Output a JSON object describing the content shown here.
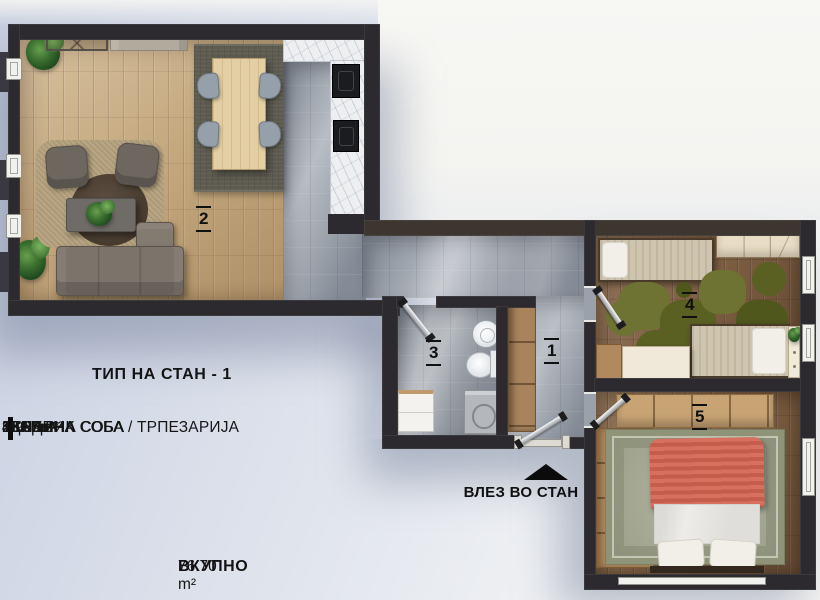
{
  "legend": {
    "title": "ТИП НА СТАН - 1",
    "rows": [
      {
        "num": "1",
        "label": "ХОДНИК",
        "area": "10.05 m²"
      },
      {
        "num": "2",
        "label": "ДНЕВНА СОБА / ТРПЕЗАРИЈА",
        "area": "35.85 m²"
      },
      {
        "num": "3",
        "label": "БАЊА",
        "area": "4.90 m²"
      },
      {
        "num": "4",
        "label": "СПАЛНА СОБА",
        "area": "11.95m²"
      },
      {
        "num": "5",
        "label": "СПАЛНА СОБА",
        "area": "13.95m²"
      }
    ],
    "total_label": "ВКУПНО",
    "total_sep": "-",
    "total_area": "76.70 m²"
  },
  "entrance": {
    "label": "ВЛЕЗ ВО СТАН"
  },
  "rooms": {
    "hallway": {
      "number": "1"
    },
    "living": {
      "number": "2"
    },
    "bathroom": {
      "number": "3"
    },
    "bedroom4": {
      "number": "4"
    },
    "bedroom5": {
      "number": "5"
    }
  },
  "colors": {
    "wall": "#2c2a2e",
    "wood_living": "#c4a77c",
    "wood_bedroom": "#7d5e42",
    "tile": "#9aa1ab",
    "marble": "#edeff1",
    "dining_rug": "#5e5c50",
    "puzzle_rug": "#65692c",
    "bedroom5_rug": "#a9ad96",
    "bed_blanket_red": "#d4685a",
    "annotation_text": "#101010",
    "background": "#d7dce8"
  }
}
